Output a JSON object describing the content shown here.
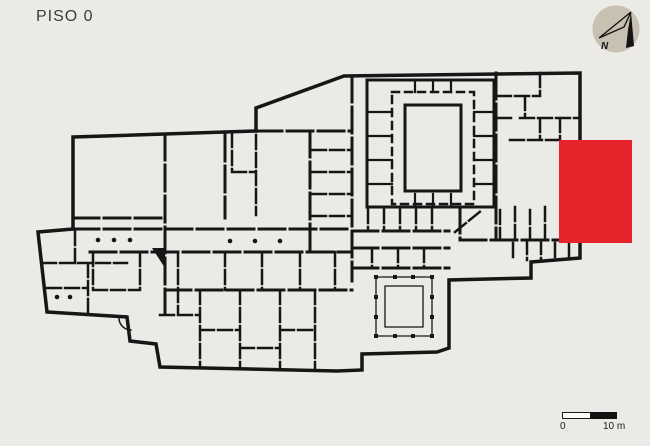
{
  "header": {
    "title": "PISO 0"
  },
  "compass": {
    "label": "N"
  },
  "scalebar": {
    "start_label": "0",
    "end_label": "10 m"
  },
  "colors": {
    "background": "#ebeae7",
    "page": "#ffffff",
    "wall": "#161616",
    "highlight": "#e5232b",
    "compass_circle": "#c8c1b2",
    "title_text": "#3c3c3c"
  }
}
